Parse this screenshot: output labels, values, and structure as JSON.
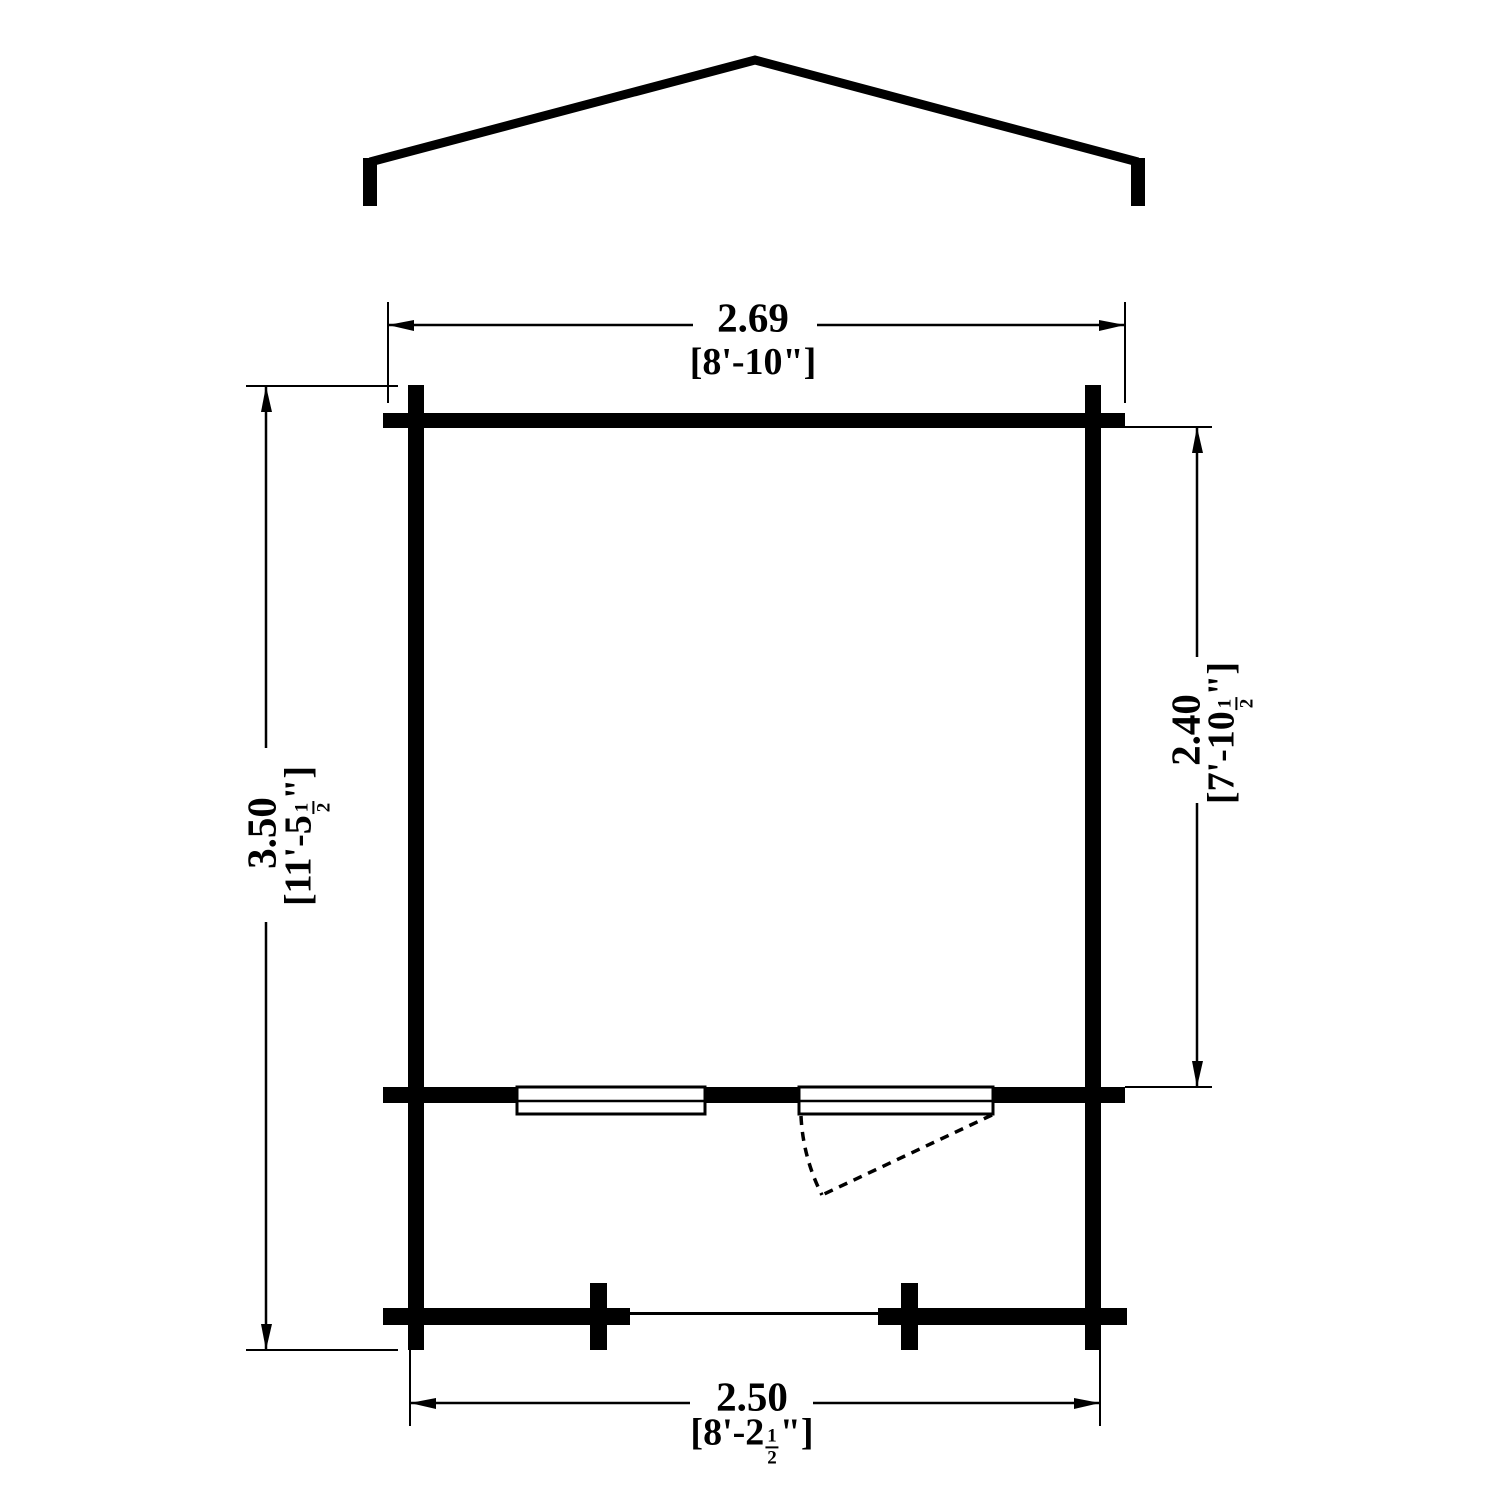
{
  "drawing": {
    "type": "floor-plan",
    "subject": "cabin-with-gable-roof-and-porch",
    "colors": {
      "line": "#000000",
      "background": "#ffffff"
    },
    "features": {
      "roof": "gable-roof-profile",
      "window": "double-window",
      "door": "door-with-dashed-swing-arc",
      "porch_posts": "2"
    }
  },
  "dimensions": {
    "top": {
      "metric": "2.69",
      "imperial": "[8'-10\"]"
    },
    "left": {
      "metric": "3.50",
      "imperial_pre": "[11'-5",
      "frac_num": "1",
      "frac_den": "2",
      "imperial_post": "\"]"
    },
    "right": {
      "metric": "2.40",
      "imperial_pre": "[7'-10",
      "frac_num": "1",
      "frac_den": "2",
      "imperial_post": "\"]"
    },
    "bottom": {
      "metric": "2.50",
      "imperial_pre": "[8'-2",
      "frac_num": "1",
      "frac_den": "2",
      "imperial_post": "\"]"
    }
  }
}
